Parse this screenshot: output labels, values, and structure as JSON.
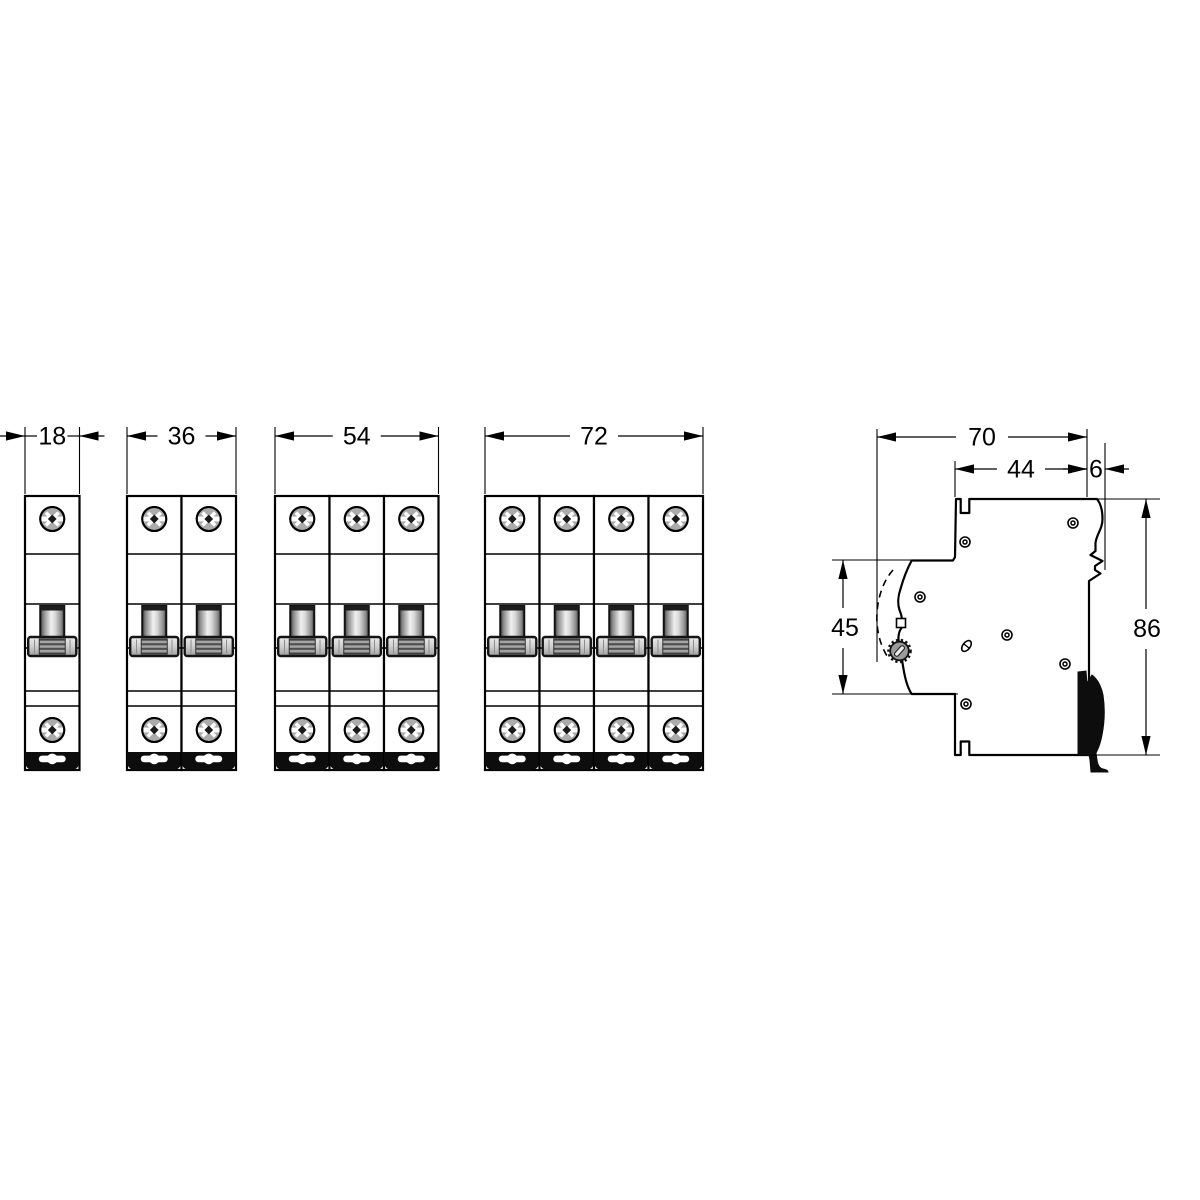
{
  "drawing": {
    "type": "technical-dimension-drawing",
    "subject": "DIN-rail modular circuit breakers: 1-4 pole front views and side view",
    "unit_note": "mm",
    "colors": {
      "line": "#000000",
      "paper": "#ffffff",
      "screw_fill": "#ababab",
      "toggle_light": "#efefef",
      "toggle_dark": "#3f3f3f",
      "knob_fill": "#9a9a9a",
      "clip_fill": "#0d0d0d"
    }
  },
  "front_views": [
    {
      "poles": 1,
      "width_label": "18"
    },
    {
      "poles": 2,
      "width_label": "36"
    },
    {
      "poles": 3,
      "width_label": "54"
    },
    {
      "poles": 4,
      "width_label": "72"
    }
  ],
  "side_view": {
    "width_total_label": "70",
    "width_front_label": "44",
    "rail_step_label": "6",
    "front_face_height_label": "45",
    "height_total_label": "86"
  }
}
